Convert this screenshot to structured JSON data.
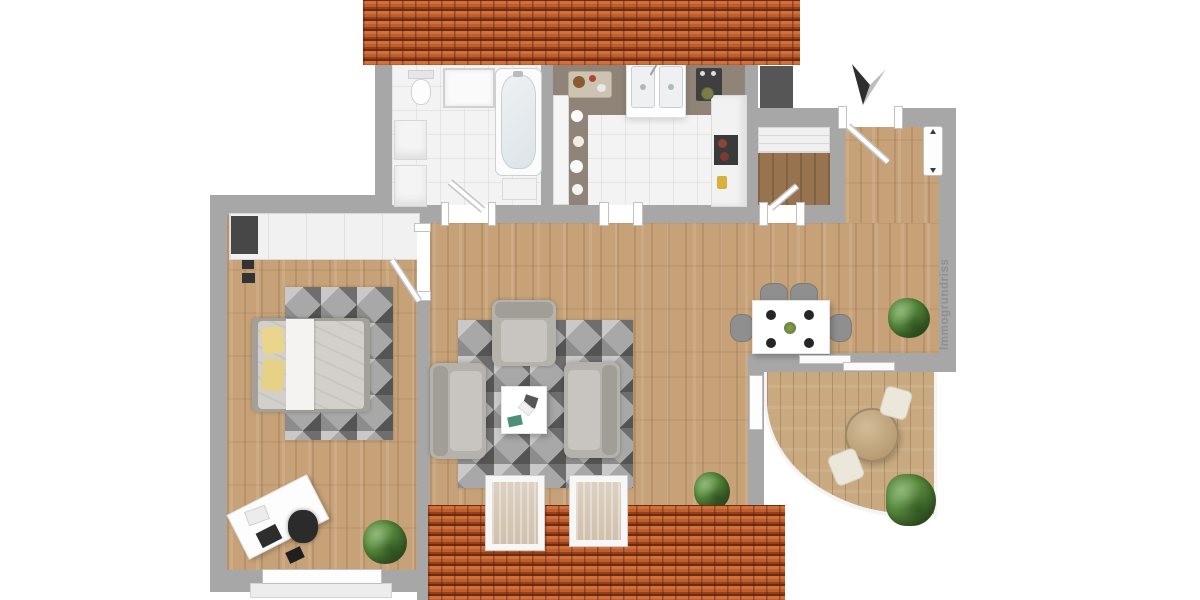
{
  "watermark": {
    "label": "Immogrundriss"
  },
  "compass": {
    "type": "north-arrow"
  },
  "palette": {
    "roof_tile": "#c4602f",
    "roof_gap": "#6d2c10",
    "wall": "#a7a7a7",
    "wood_floor": "#c7a278",
    "storage_floor": "#97744f",
    "balcony_deck": "#c9aa80",
    "bath_kitchen_tile": "#f3f3f3",
    "countertop": "#8f8477",
    "rug_grays": [
      "#545454",
      "#6e6e6e",
      "#8c8c8c",
      "#c9c9c9"
    ],
    "sofa_gray": "#b5b1ab",
    "bed_duvet": "#d3d0cb",
    "pillow_yellow": "#e9d68c",
    "dining_chair_gray": "#8f8f8f",
    "plant_green": "#4e7d34",
    "watermark_gray": "#8f8f8f"
  },
  "plan": {
    "rooms": [
      {
        "name": "bathroom",
        "furniture": [
          "toilet",
          "shower",
          "bathtub",
          "vanity-cabinets",
          "bath-cabinet",
          "bath-door"
        ]
      },
      {
        "name": "kitchen",
        "furniture": [
          "countertop",
          "double-sink",
          "cooktop",
          "cutting-board",
          "tall-cabinets",
          "built-in-oven",
          "bowls"
        ]
      },
      {
        "name": "entry-hall",
        "furniture": [
          "front-door",
          "doormat-shaft",
          "wall-window"
        ]
      },
      {
        "name": "storage-room",
        "furniture": [
          "shelf-unit",
          "storage-door"
        ]
      },
      {
        "name": "bedroom-office",
        "furniture": [
          "wardrobe",
          "double-bed",
          "yellow-pillows",
          "geometric-rug",
          "desk",
          "office-chair",
          "laptop",
          "potted-plant",
          "window",
          "bedroom-door"
        ]
      },
      {
        "name": "living-room",
        "furniture": [
          "armchair-top",
          "armchair-left",
          "armchair-right",
          "coffee-table",
          "geometric-rug",
          "potted-plant",
          "skylight-1",
          "skylight-2"
        ]
      },
      {
        "name": "dining-area",
        "furniture": [
          "dining-table",
          "place-settings",
          "dining-chairs",
          "potted-plant",
          "sliding-door"
        ]
      },
      {
        "name": "balcony",
        "furniture": [
          "round-table",
          "terrace-chair-1",
          "terrace-chair-2",
          "shrub",
          "curved-parapet"
        ]
      }
    ]
  }
}
